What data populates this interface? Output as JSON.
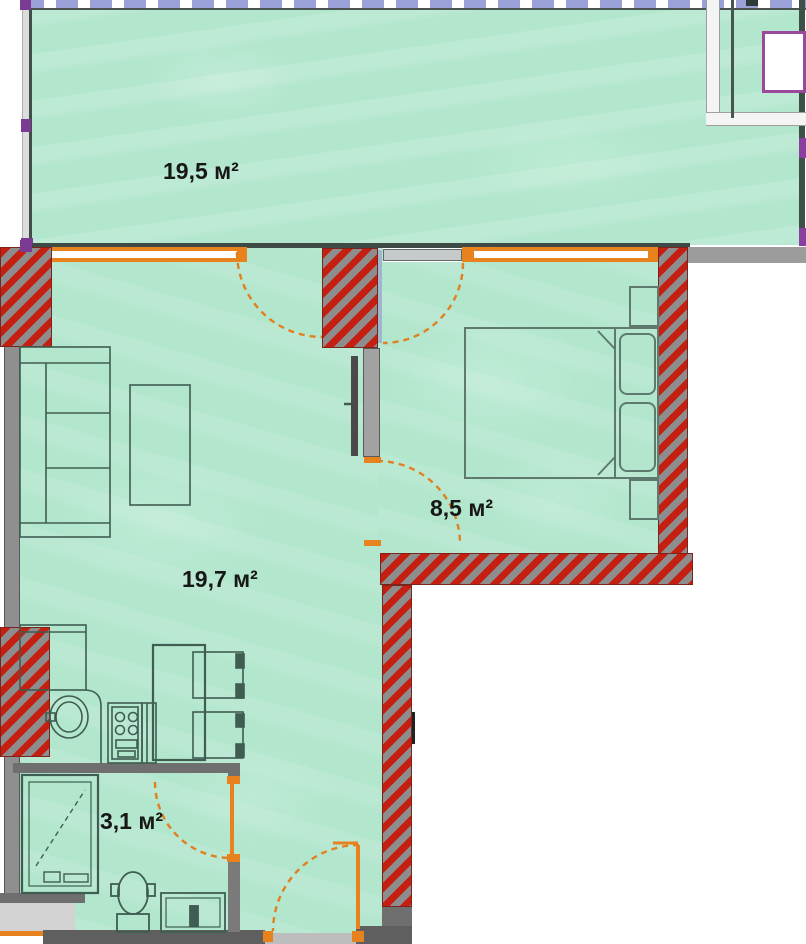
{
  "plan": {
    "type": "apartment-floor-plan",
    "rooms": [
      {
        "name": "terrace",
        "area_label": "19,5 м²"
      },
      {
        "name": "living-kitchen",
        "area_label": "19,7 м²"
      },
      {
        "name": "bedroom",
        "area_label": "8,5 м²"
      },
      {
        "name": "bathroom",
        "area_label": "3,1 м²"
      }
    ],
    "colors": {
      "floor_mint": "#b2e6cd",
      "wall_hatch_red": "#c41f10",
      "wall_hatch_gray": "#8d8d8d",
      "wall_dark_gray": "#5f5f5f",
      "window_door_orange": "#e8821f",
      "glazing_lavender": "#9aa0d8",
      "accent_purple": "#8a3f9e",
      "furniture_line_green": "#3f5d52",
      "label_text": "#171717"
    }
  }
}
